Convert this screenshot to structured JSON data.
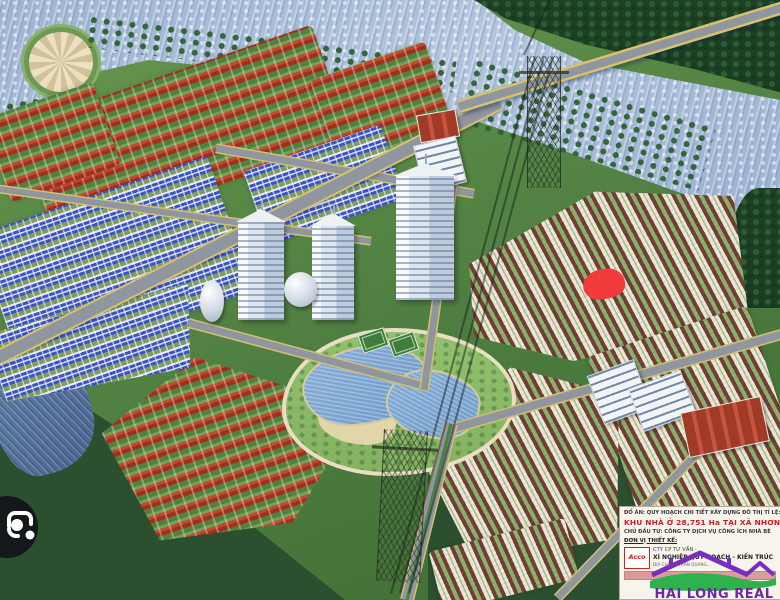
{
  "info_box": {
    "line1": "ĐỒ ÁN: QUY HOẠCH CHI TIẾT XÂY DỰNG ĐÔ THỊ TỈ LỆ: 1/",
    "line2": "KHU NHÀ Ở 28,751 Ha TẠI XÃ NHƠN ĐỨC",
    "line3": "CHỦ ĐẦU TƯ: CÔNG TY DỊCH VỤ CÔNG ÍCH NHÀ BÈ",
    "line4": "ĐƠN VỊ THIẾT KẾ:",
    "designer": {
      "logo": "Acco",
      "row1": "CTY CP TƯ VẤN -",
      "row2": "XÍ NGHIỆP QUY HOẠCH - KIẾN TRÚC",
      "row3": "ĐỊA CHỈ: 36 TRẦN QUANG..."
    }
  },
  "watermark": {
    "text": "HAI LONG REAL",
    "house_color": "#7a2ec0",
    "wave_color": "#2fb14b",
    "text_color": "#6d28a8"
  },
  "annotation_marker": {
    "color": "#f23b3b"
  },
  "icons": {
    "camera_lens": "camera-lens-icon",
    "acco_logo": "acco-triangle-logo"
  },
  "colors": {
    "river": "#a9bdd8",
    "forest": "#1d4124",
    "field": "#2b4f2f",
    "road": "#8f96a0",
    "road_edge": "#d8c16b",
    "villa_roof": "#a0301d",
    "blue_roof": "#3c54c0",
    "town_roof": "#6f4133",
    "tower": "#edf1f6",
    "lake": "#7aa3cf",
    "marker": "#f23b3b"
  },
  "zones": [
    {
      "name": "river",
      "type": "water-river",
      "x": 0,
      "y": 0,
      "w": 780,
      "h": 250,
      "clip": "0% 0%, 61% 0%, 66% 12%, 75% 25%, 100% 40%, 100% 95%, 88% 78%, 72% 60%, 55% 42%, 38% 30%, 19% 24%, 8% 32%, 4.5% 52%, 0% 55%"
    },
    {
      "name": "forest-top-right",
      "type": "forest",
      "x": 468,
      "y": 0,
      "w": 312,
      "h": 132,
      "clip": "2% 0%, 100% 0%, 100% 70%, 72% 52%, 38% 34%, 12% 14%"
    },
    {
      "name": "forest-right-bank",
      "type": "forest",
      "x": 728,
      "y": 188,
      "w": 52,
      "h": 120,
      "br": "60% 0 0 40%"
    },
    {
      "name": "field-bottom-left",
      "type": "field-dark",
      "x": 0,
      "y": 372,
      "w": 345,
      "h": 228,
      "clip": "0% 0%, 16% 7%, 42% 32%, 72% 66%, 100% 100%, 0% 100%"
    },
    {
      "name": "field-bottom-center",
      "type": "field-dark",
      "x": 428,
      "y": 428,
      "w": 278,
      "h": 172,
      "clip": "0% 28%, 18% 6%, 52% 0%, 100% 22%, 100% 100%, 0% 100%"
    },
    {
      "name": "stream-left",
      "type": "water-stream",
      "x": -8,
      "y": 356,
      "w": 100,
      "h": 118,
      "rot": -14,
      "br": "55% 45% 60% 40% / 50% 55% 45% 60%"
    },
    {
      "name": "plaza-circle",
      "type": "plaza",
      "x": 24,
      "y": 27,
      "w": 64,
      "h": 60
    },
    {
      "name": "grove-river-bank-left",
      "type": "grove",
      "x": 86,
      "y": 38,
      "w": 370,
      "h": 32,
      "rot": 7
    },
    {
      "name": "grove-river-bank-right",
      "type": "grove",
      "x": 462,
      "y": 92,
      "w": 250,
      "h": 66,
      "rot": 16
    },
    {
      "name": "grove-park-topleft",
      "type": "grove",
      "x": 10,
      "y": 96,
      "w": 80,
      "h": 70,
      "rot": -10
    },
    {
      "name": "grove-bottom-right",
      "type": "grove",
      "x": 636,
      "y": 428,
      "w": 140,
      "h": 100,
      "rot": -8
    },
    {
      "name": "villas-top-left",
      "type": "villa-red",
      "x": 28,
      "y": 72,
      "w": 312,
      "h": 122,
      "rot": -19,
      "br": "6px"
    },
    {
      "name": "villas-left-edge",
      "type": "villa-red",
      "x": -6,
      "y": 98,
      "w": 116,
      "h": 88,
      "rot": -19,
      "br": "6px"
    },
    {
      "name": "villas-top-mid",
      "type": "villa-red",
      "x": 322,
      "y": 58,
      "w": 122,
      "h": 98,
      "rot": -19,
      "br": "6px"
    },
    {
      "name": "villas-bottom-left",
      "type": "villa-red",
      "x": 112,
      "y": 348,
      "w": 252,
      "h": 188,
      "rot": -19,
      "clip": "0% 22%, 45% 0%, 100% 55%, 60% 100%, 8% 86%"
    },
    {
      "name": "rowhouses-blue-left",
      "type": "row-blue",
      "x": -8,
      "y": 192,
      "w": 245,
      "h": 142,
      "rot": -19,
      "br": "4px"
    },
    {
      "name": "rowhouses-blue-center",
      "type": "row-blue",
      "x": 252,
      "y": 146,
      "w": 145,
      "h": 78,
      "rot": -19,
      "br": "4px"
    },
    {
      "name": "rowhouses-blue-lower-left",
      "type": "row-blue",
      "x": -6,
      "y": 298,
      "w": 210,
      "h": 98,
      "rot": -19,
      "clip": "0% 0%, 100% 18%, 88% 100%, 0% 72%"
    },
    {
      "name": "townhouses-right-upper",
      "type": "row-town",
      "x": 462,
      "y": 192,
      "w": 290,
      "h": 168,
      "rot": -18,
      "clip": "6% 18%, 55% 0%, 100% 28%, 92% 100%, 30% 92%, 0% 60%"
    },
    {
      "name": "townhouses-right-lower",
      "type": "row-town",
      "x": 616,
      "y": 326,
      "w": 168,
      "h": 212,
      "rot": -18,
      "br": "6px"
    },
    {
      "name": "townhouses-center-lower",
      "type": "row-town",
      "x": 426,
      "y": 366,
      "w": 210,
      "h": 196,
      "rot": -18,
      "clip": "0% 20%, 55% 0%, 100% 30%, 78% 100%, 10% 88%"
    },
    {
      "name": "townhouses-bottom-strip",
      "type": "row-town",
      "x": 434,
      "y": 534,
      "w": 140,
      "h": 62,
      "rot": -14,
      "br": "4px"
    },
    {
      "name": "central-park",
      "type": "park",
      "x": 282,
      "y": 328,
      "w": 226,
      "h": 140,
      "br": "48% 52% 55% 45% / 55% 48% 52% 45%"
    },
    {
      "name": "park-sand",
      "type": "sand",
      "x": 318,
      "y": 398,
      "w": 78,
      "h": 46,
      "rot": 8,
      "br": "50% 50% 45% 55% / 55% 45% 50% 50%"
    },
    {
      "name": "lake-west",
      "type": "lake",
      "x": 302,
      "y": 346,
      "w": 126,
      "h": 74,
      "rot": -8,
      "br": "55% 45% 60% 40% / 50% 60% 40% 55%"
    },
    {
      "name": "lake-east",
      "type": "lake",
      "x": 386,
      "y": 370,
      "w": 90,
      "h": 64,
      "rot": 10,
      "br": "50% 60% 45% 55% / 60% 45% 55% 50%"
    },
    {
      "name": "tennis-court-1",
      "type": "court",
      "x": 360,
      "y": 331,
      "w": 27,
      "h": 19,
      "rot": -19
    },
    {
      "name": "tennis-court-2",
      "type": "court",
      "x": 390,
      "y": 335,
      "w": 27,
      "h": 19,
      "rot": -19
    },
    {
      "name": "road-upper-left",
      "type": "road",
      "x": -12,
      "y": 210,
      "w": 385,
      "h": 9,
      "rot": 8
    },
    {
      "name": "road-above-towers",
      "type": "road",
      "x": 214,
      "y": 166,
      "w": 262,
      "h": 10,
      "rot": 10
    },
    {
      "name": "road-below-towers",
      "type": "road",
      "x": 184,
      "y": 350,
      "w": 248,
      "h": 10,
      "rot": 15
    },
    {
      "name": "road-right-of-towers",
      "type": "road",
      "x": 326,
      "y": 272,
      "w": 228,
      "h": 10,
      "rot": -82
    },
    {
      "name": "road-mid-right",
      "type": "road",
      "x": 446,
      "y": 376,
      "w": 342,
      "h": 11,
      "rot": -16
    },
    {
      "name": "road-bottom-right",
      "type": "road",
      "x": 526,
      "y": 519,
      "w": 206,
      "h": 10,
      "rot": -46
    },
    {
      "name": "road-bottom-median",
      "type": "road-median",
      "x": 338,
      "y": 505,
      "w": 182,
      "h": 14,
      "rot": -76
    },
    {
      "name": "boulevard",
      "type": "road-main",
      "x": -32,
      "y": 222,
      "w": 562,
      "h": 16,
      "rot": -27
    },
    {
      "name": "bridge",
      "type": "bridge",
      "x": 452,
      "y": 50,
      "w": 342,
      "h": 13,
      "rot": -17
    },
    {
      "name": "riverside-pavilion",
      "type": "pavilion",
      "x": 418,
      "y": 112,
      "w": 38,
      "h": 26,
      "rot": -10
    },
    {
      "name": "riverside-building",
      "type": "school",
      "x": 418,
      "y": 140,
      "w": 42,
      "h": 46,
      "rot": -14
    },
    {
      "name": "office-tower-left",
      "type": "tower",
      "x": 238,
      "y": 222,
      "w": 46,
      "h": 98
    },
    {
      "name": "office-tower-mid",
      "type": "tower",
      "x": 312,
      "y": 226,
      "w": 42,
      "h": 94
    },
    {
      "name": "office-tower-tall",
      "type": "tower",
      "x": 396,
      "y": 176,
      "w": 58,
      "h": 124
    },
    {
      "name": "round-podium",
      "type": "cylinder",
      "x": 284,
      "y": 272,
      "w": 33,
      "h": 35
    },
    {
      "name": "water-tower",
      "type": "cylinder",
      "x": 200,
      "y": 280,
      "w": 24,
      "h": 42
    },
    {
      "name": "school-block-a",
      "type": "school",
      "x": 594,
      "y": 366,
      "w": 48,
      "h": 50,
      "rot": -20
    },
    {
      "name": "school-block-b",
      "type": "school",
      "x": 634,
      "y": 378,
      "w": 54,
      "h": 44,
      "rot": -20
    },
    {
      "name": "clubhouse-red-roof",
      "type": "pavilion",
      "x": 684,
      "y": 404,
      "w": 80,
      "h": 44,
      "rot": -12
    },
    {
      "name": "power-pylon-north",
      "type": "pylon",
      "x": 527,
      "y": 56,
      "w": 32,
      "h": 132
    },
    {
      "name": "power-pylon-south",
      "type": "pylon",
      "x": 380,
      "y": 430,
      "w": 42,
      "h": 152,
      "rot": 3
    },
    {
      "name": "power-line-top",
      "type": "wire",
      "x": 506,
      "y": 26,
      "w": 62,
      "h": 2,
      "rot": 115
    },
    {
      "name": "power-line-1",
      "type": "wire",
      "x": 194,
      "y": 324,
      "w": 556,
      "h": 2,
      "rot": 105
    },
    {
      "name": "power-line-2",
      "type": "wire",
      "x": 203,
      "y": 324,
      "w": 556,
      "h": 2,
      "rot": 105
    },
    {
      "name": "power-line-3",
      "type": "wire",
      "x": 185,
      "y": 324,
      "w": 556,
      "h": 2,
      "rot": 105
    },
    {
      "name": "location-marker",
      "type": "marker",
      "x": 583,
      "y": 269,
      "w": 42,
      "h": 30,
      "rot": -6
    }
  ]
}
